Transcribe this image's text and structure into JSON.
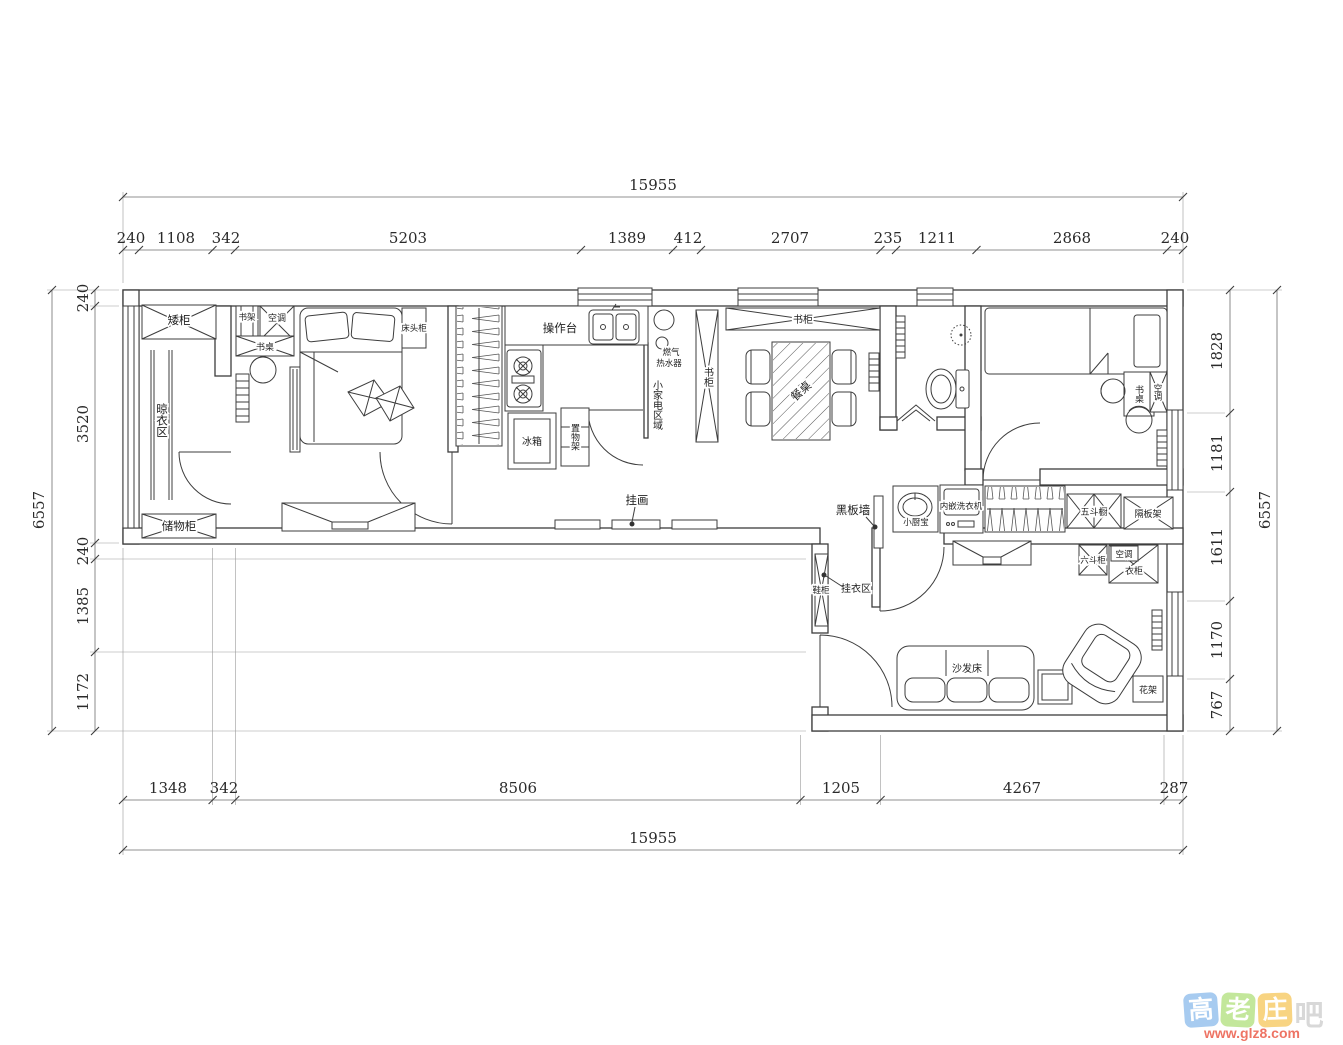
{
  "dims": {
    "total_h": "15955",
    "total_v": "6557",
    "top": [
      "240",
      "1108",
      "342",
      "5203",
      "1389",
      "412",
      "2707",
      "235",
      "1211",
      "2868",
      "240"
    ],
    "bottom": [
      "1348",
      "342",
      "8506",
      "1205",
      "4267",
      "287"
    ],
    "left": [
      "240",
      "3520",
      "240",
      "1385",
      "1172"
    ],
    "right": [
      "1828",
      "1181",
      "1611",
      "1170",
      "767"
    ]
  },
  "labels": {
    "low_cabinet": "矮柜",
    "drying_area": "晾衣区",
    "storage_cabinet": "储物柜",
    "book_shelf": "书架",
    "air_conditioner": "空调",
    "desk": "书桌",
    "bedside_table": "床头柜",
    "worktop": "操作台",
    "gas_line1": "燃气",
    "gas_line2": "热水器",
    "small_appliance_area": "小家电区域",
    "fridge": "冰箱",
    "storage_rack": "置物架",
    "bookcase": "书柜",
    "dining_table": "餐桌",
    "hanging_picture": "挂画",
    "blackboard_wall": "黑板墙",
    "mini_water_heater": "小厨宝",
    "built_in_washer": "内嵌洗衣机",
    "five_drawer_chest": "五斗橱",
    "partition_shelf": "隔板架",
    "six_drawer_cabinet": "六斗柜",
    "wardrobe": "衣柜",
    "shoe_cabinet": "鞋柜",
    "coat_hanging_area": "挂衣区",
    "sofa_bed": "沙发床",
    "flower_stand": "花架"
  },
  "watermark": {
    "chars": [
      "高",
      "老",
      "庄",
      "吧"
    ],
    "url": "www.glz8.com",
    "tile_colors": [
      "#7fb3e8",
      "#a8dd6e",
      "#f5c04a",
      "#c6c6c6"
    ],
    "url_color": "#e8432e"
  },
  "style": {
    "line_color": "#3d3d3d",
    "background": "#ffffff"
  }
}
